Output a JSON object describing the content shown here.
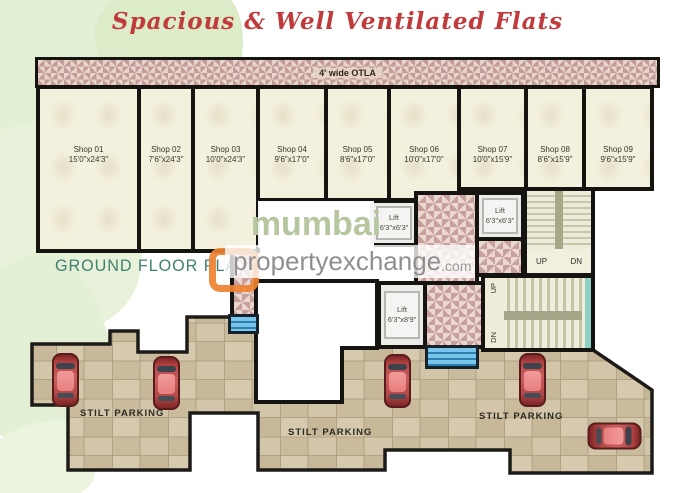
{
  "title": "Spacious & Well Ventilated Flats",
  "plan_label": "GROUND FLOOR PLAN",
  "otla_label": "4' wide OTLA",
  "shops": [
    {
      "name": "Shop 01",
      "dims": "15'0\"x24'3\""
    },
    {
      "name": "Shop 02",
      "dims": "7'6\"x24'3\""
    },
    {
      "name": "Shop 03",
      "dims": "10'0\"x24'3\""
    },
    {
      "name": "Shop 04",
      "dims": "9'6\"x17'0\""
    },
    {
      "name": "Shop 05",
      "dims": "8'6\"x17'0\""
    },
    {
      "name": "Shop 06",
      "dims": "10'0\"x17'0\""
    },
    {
      "name": "Shop 07",
      "dims": "10'0\"x15'9\""
    },
    {
      "name": "Shop 08",
      "dims": "8'6\"x15'9\""
    },
    {
      "name": "Shop 09",
      "dims": "9'6\"x15'9\""
    }
  ],
  "lifts": [
    {
      "name": "Lift",
      "dims": "6'3\"x6'3\""
    },
    {
      "name": "Lift",
      "dims": "6'3\"x6'3\""
    },
    {
      "name": "Lift",
      "dims": "6'3\"x8'9\""
    }
  ],
  "stairs": {
    "up": "UP",
    "dn": "DN"
  },
  "passage_label": "Passage",
  "parking_labels": [
    "STILT PARKING",
    "STILT PARKING",
    "STILT PARKING"
  ],
  "watermark": {
    "line1": "mumbai",
    "line2": "propertyexchange",
    "domain": ".com"
  },
  "colors": {
    "title_red": "#c13a3c",
    "plan_teal": "#40806f",
    "watermark_green": "#b6c69e",
    "watermark_gray": "#8f8f8f",
    "logo_orange": "#ee8232",
    "car_red": "#c05050",
    "parking_tan": "#cfc1a5",
    "entry_steps_blue": "#5fb6e2",
    "stair_glass_teal": "#8ed0c5",
    "wall_black": "#161410",
    "otla_pattern_pink": "#c59a9a"
  }
}
